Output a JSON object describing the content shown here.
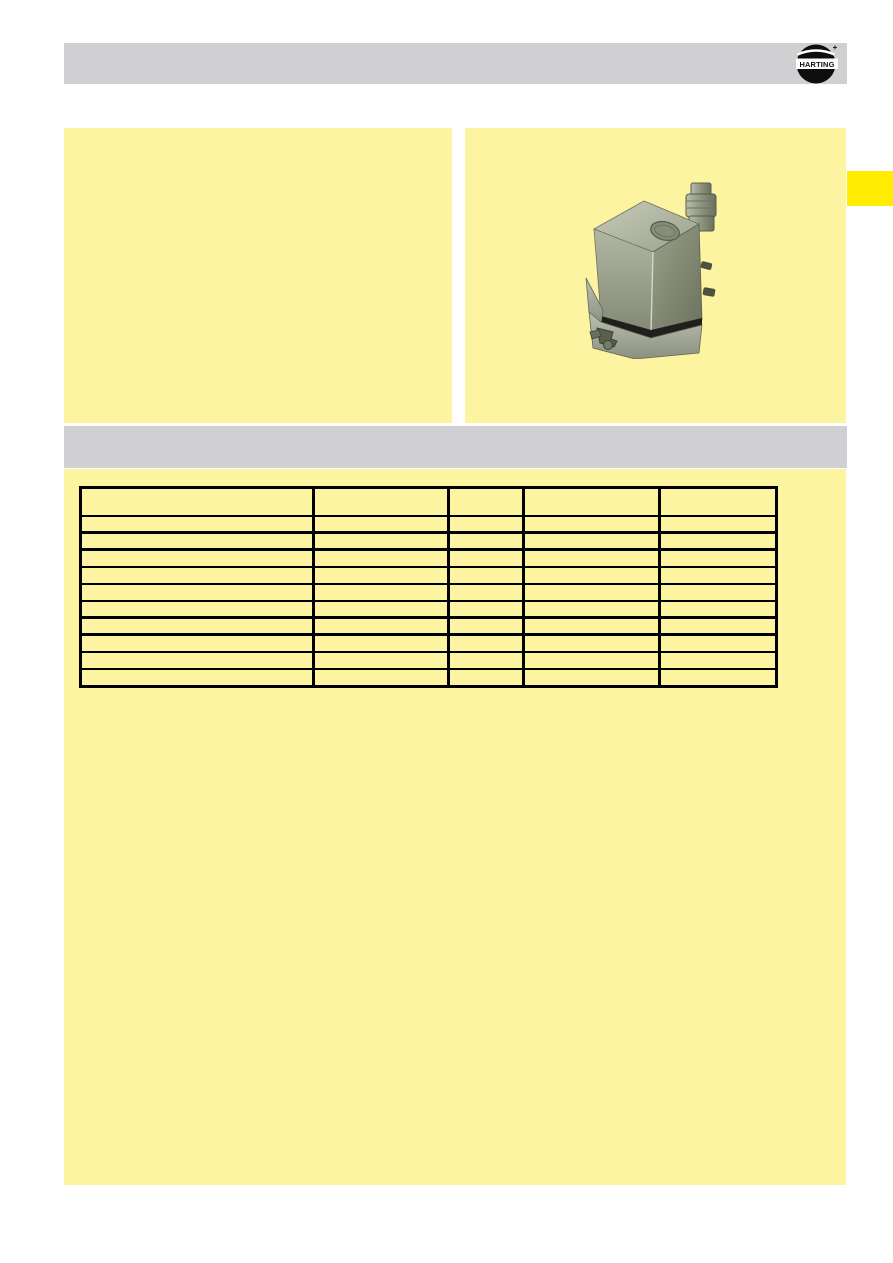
{
  "colors": {
    "page_bg": "#ffffff",
    "panel_yellow": "#fcf4a0",
    "accent_yellow": "#ffec00",
    "bar_gray": "#d0d0d2",
    "line_black": "#000000"
  },
  "header": {
    "logo_text": "HARTING",
    "logo_plus": "+"
  },
  "left_panel": {
    "text": ""
  },
  "right_panel": {
    "image": "han-connector-hood-photo"
  },
  "edge_tab": {
    "label": ""
  },
  "section_bar": {
    "title": ""
  },
  "table": {
    "header": {
      "cells": [
        "",
        "",
        "",
        "",
        ""
      ]
    },
    "rows": [
      {
        "cells": [
          "",
          "",
          "",
          "",
          ""
        ],
        "thick_bottom": true
      },
      {
        "cells": [
          "",
          "",
          "",
          "",
          ""
        ],
        "thick_bottom": true
      },
      {
        "cells": [
          "",
          "",
          "",
          "",
          ""
        ],
        "thick_bottom": false
      },
      {
        "cells": [
          "",
          "",
          "",
          "",
          ""
        ],
        "thick_bottom": false
      },
      {
        "cells": [
          "",
          "",
          "",
          "",
          ""
        ],
        "thick_bottom": false
      },
      {
        "cells": [
          "",
          "",
          "",
          "",
          ""
        ],
        "thick_bottom": true
      },
      {
        "cells": [
          "",
          "",
          "",
          "",
          ""
        ],
        "thick_bottom": true
      },
      {
        "cells": [
          "",
          "",
          "",
          "",
          ""
        ],
        "thick_bottom": false
      },
      {
        "cells": [
          "",
          "",
          "",
          "",
          ""
        ],
        "thick_bottom": false
      },
      {
        "cells": [
          "",
          "",
          "",
          "",
          ""
        ],
        "thick_bottom": false
      }
    ]
  }
}
